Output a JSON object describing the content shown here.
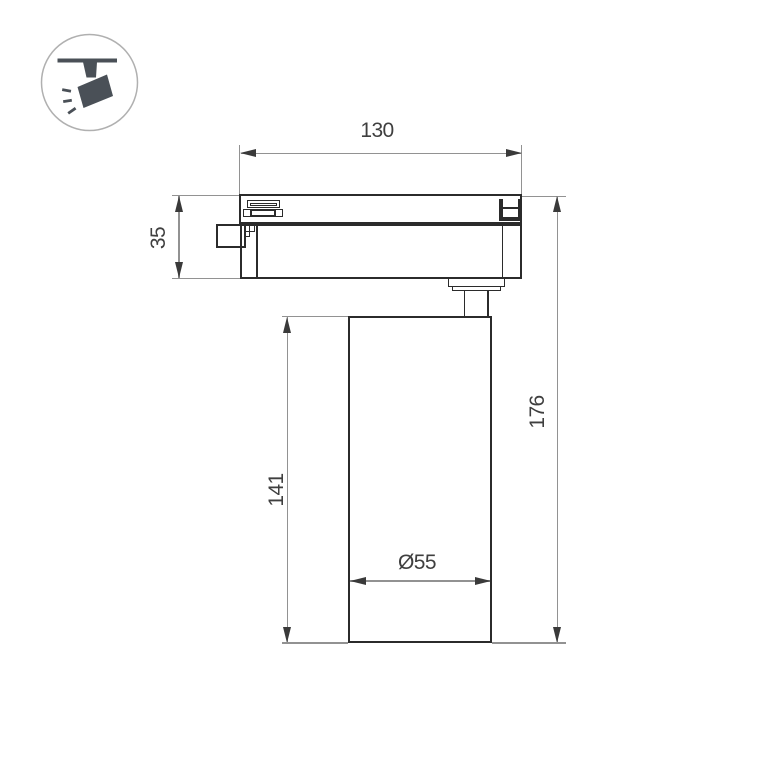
{
  "icon": {
    "name": "track-spotlight-icon"
  },
  "dimensions": {
    "track_width": "130",
    "adapter_height": "35",
    "body_height": "141",
    "overall_height": "176",
    "body_diameter": "Ø55"
  },
  "colors": {
    "outline": "#2b2b2b",
    "dimension_line": "#929292",
    "arrowhead": "#3a3a3a",
    "label_text": "#3f3f3f",
    "icon_fill": "#4a5057",
    "icon_circle": "#b0b0b0",
    "background": "#ffffff"
  }
}
